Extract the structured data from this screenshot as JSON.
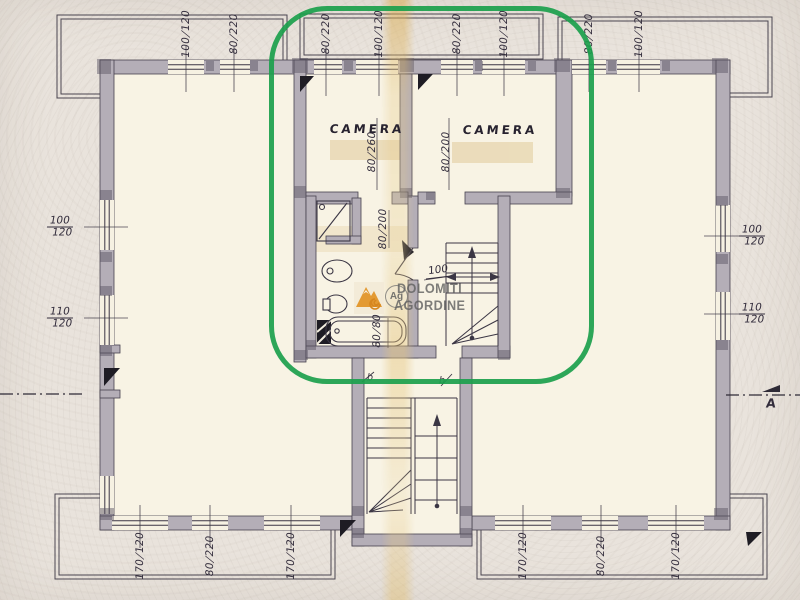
{
  "page": {
    "kind": "scanned architectural floor plan"
  },
  "highlight": {
    "color": "#1ba04c"
  },
  "ink_color": "#3b3644",
  "paper_color": "#e9e3dc",
  "wall_color": "#b4aeb7",
  "room_fill": "#f8f3e4",
  "watermark": {
    "line1": "DOLOMITI",
    "line2": "AGORDINE",
    "monogram": "Ag",
    "logo": "orange-mountain-spiral"
  },
  "rooms": [
    {
      "label": "CAMERA",
      "x": 367,
      "y": 129
    },
    {
      "label": "CAMERA",
      "x": 500,
      "y": 130
    }
  ],
  "door_marks": [
    {
      "text": "b",
      "x": 370,
      "y": 378
    },
    {
      "text": "b",
      "x": 442,
      "y": 381
    }
  ],
  "stair_note": {
    "text": "100",
    "x": 438,
    "y": 271
  },
  "section_marker": {
    "text": "A",
    "x": 771,
    "y": 403
  },
  "dimensions": [
    {
      "text": "100/120",
      "x": 186,
      "y": 34,
      "o": "v"
    },
    {
      "text": "80/220",
      "x": 234,
      "y": 34,
      "o": "v"
    },
    {
      "text": "80/220",
      "x": 326,
      "y": 34,
      "o": "v"
    },
    {
      "text": "100/120",
      "x": 379,
      "y": 34,
      "o": "v"
    },
    {
      "text": "80/220",
      "x": 457,
      "y": 34,
      "o": "v"
    },
    {
      "text": "100/120",
      "x": 504,
      "y": 34,
      "o": "v"
    },
    {
      "text": "80/220",
      "x": 589,
      "y": 34,
      "o": "v"
    },
    {
      "text": "100/120",
      "x": 639,
      "y": 34,
      "o": "v"
    },
    {
      "text": "100/120",
      "x": 60,
      "y": 227,
      "o": "h"
    },
    {
      "text": "110/120",
      "x": 60,
      "y": 318,
      "o": "h"
    },
    {
      "text": "100/120",
      "x": 752,
      "y": 236,
      "o": "h"
    },
    {
      "text": "110/120",
      "x": 752,
      "y": 314,
      "o": "h"
    },
    {
      "text": "170/120",
      "x": 140,
      "y": 556,
      "o": "v"
    },
    {
      "text": "80/220",
      "x": 210,
      "y": 556,
      "o": "v"
    },
    {
      "text": "170/120",
      "x": 291,
      "y": 556,
      "o": "v"
    },
    {
      "text": "170/120",
      "x": 523,
      "y": 556,
      "o": "v"
    },
    {
      "text": "80/220",
      "x": 601,
      "y": 556,
      "o": "v"
    },
    {
      "text": "170/120",
      "x": 676,
      "y": 556,
      "o": "v"
    },
    {
      "text": "80/260",
      "x": 372,
      "y": 152,
      "o": "v"
    },
    {
      "text": "80/200",
      "x": 446,
      "y": 152,
      "o": "v"
    },
    {
      "text": "80/200",
      "x": 383,
      "y": 229,
      "o": "v"
    },
    {
      "text": "80/80",
      "x": 377,
      "y": 331,
      "o": "v"
    }
  ]
}
